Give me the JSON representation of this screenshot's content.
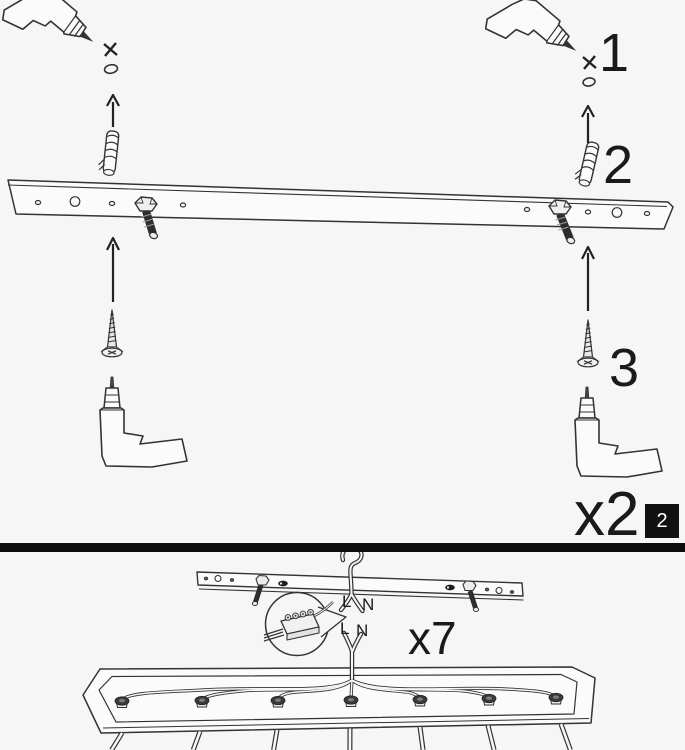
{
  "step_panel": {
    "steps": [
      {
        "label": "1"
      },
      {
        "label": "2"
      },
      {
        "label": "3"
      }
    ],
    "quantity": "x2",
    "page_number": "2"
  },
  "wiring_panel": {
    "labels": {
      "supply_live": "L",
      "supply_neutral": "N",
      "fixture_live": "L",
      "fixture_neutral": "N"
    },
    "multiplier": "x7"
  },
  "colors": {
    "background": "#f6f6f6",
    "line": "#333333",
    "dark_fill": "#2d2d2d",
    "divider": "#0d0d0d",
    "badge_background": "#111111",
    "badge_text": "#ffffff"
  }
}
